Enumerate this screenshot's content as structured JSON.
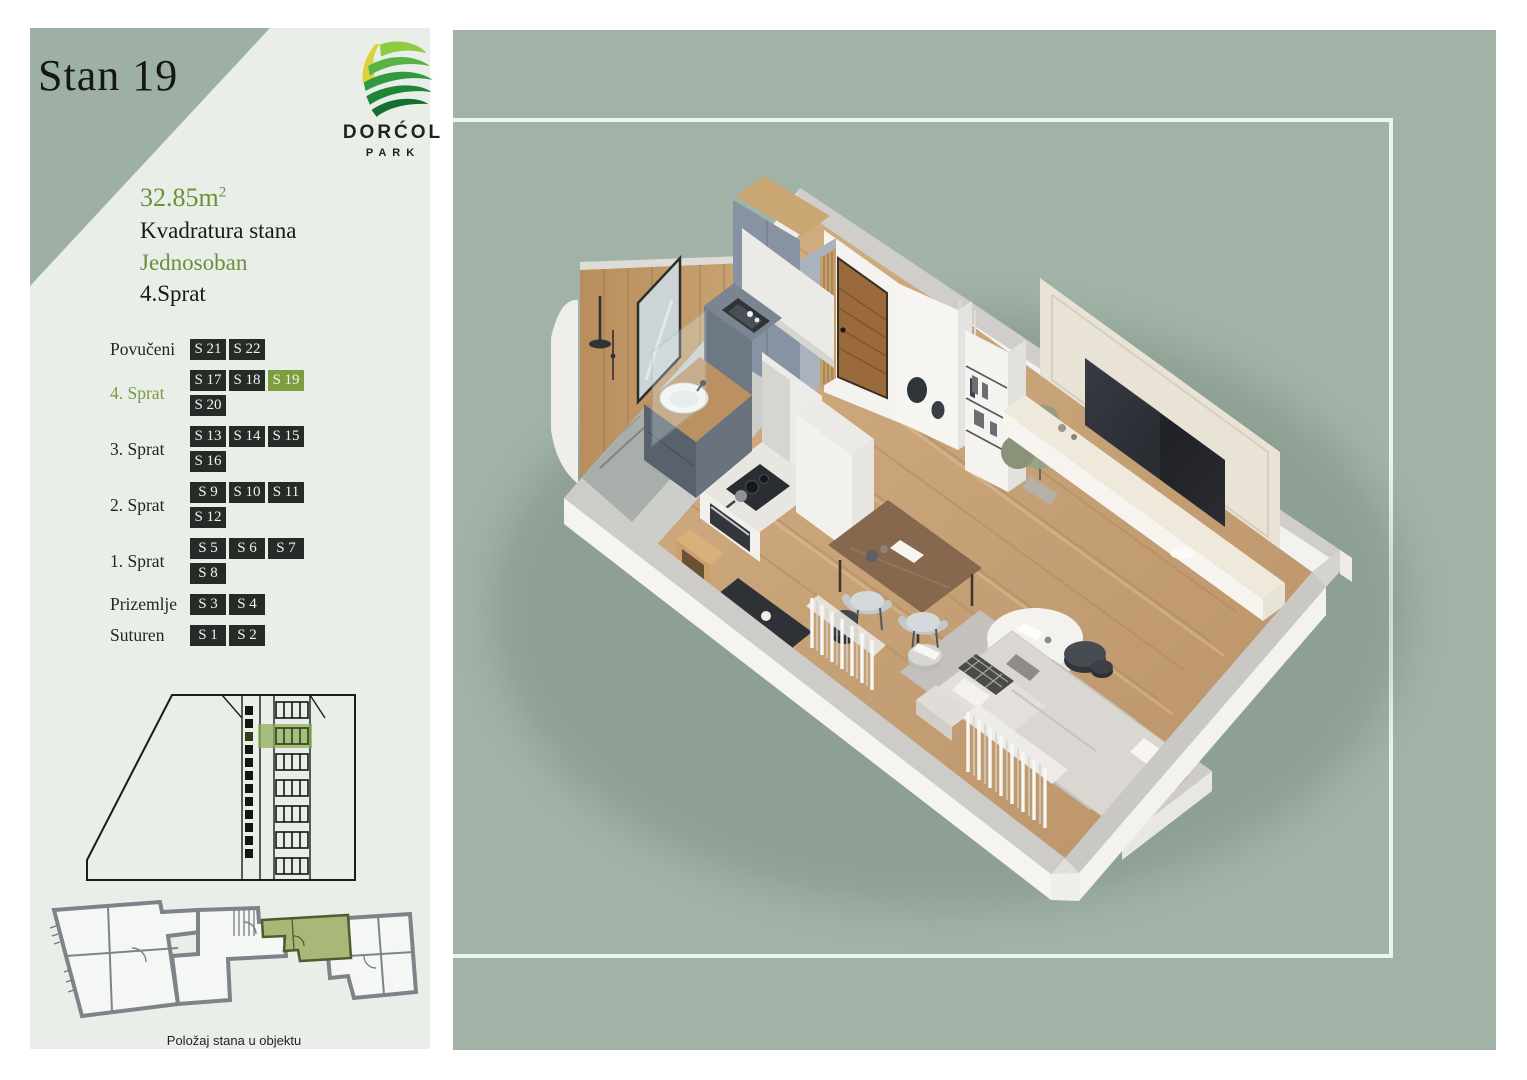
{
  "page": {
    "title": "Stan 19"
  },
  "logo": {
    "name": "DORĆOL",
    "sub": "PARK"
  },
  "details": {
    "area": "32.85m",
    "area_sup": "2",
    "area_label": "Kvadratura stana",
    "type": "Jednosoban",
    "floor": "4.Sprat"
  },
  "floors": [
    {
      "label": "Povučeni",
      "active_label": false,
      "active_unit": null,
      "units": [
        "S 21",
        "S 22"
      ]
    },
    {
      "label": "4. Sprat",
      "active_label": true,
      "active_unit": "S 19",
      "units": [
        "S 17",
        "S 18",
        "S 19",
        "S 20"
      ]
    },
    {
      "label": "3. Sprat",
      "active_label": false,
      "active_unit": null,
      "units": [
        "S 13",
        "S 14",
        "S 15",
        "S 16"
      ]
    },
    {
      "label": "2. Sprat",
      "active_label": false,
      "active_unit": null,
      "units": [
        "S 9",
        "S 10",
        "S 11",
        "S 12"
      ]
    },
    {
      "label": "1. Sprat",
      "active_label": false,
      "active_unit": null,
      "units": [
        "S 5",
        "S 6",
        "S 7",
        "S 8"
      ]
    },
    {
      "label": "Prizemlje",
      "active_label": false,
      "active_unit": null,
      "units": [
        "S 3",
        "S 4"
      ]
    },
    {
      "label": "Suturen",
      "active_label": false,
      "active_unit": null,
      "units": [
        "S 1",
        "S 2"
      ]
    }
  ],
  "diagrams": {
    "position_caption": "Položaj stana u objektu",
    "section_icon": "building-cross-section",
    "plan_icon": "floor-position-plan"
  },
  "colors": {
    "accent_green": "#7b9e3e",
    "text_green": "#6e8f38",
    "panel_green": "#a1b3a7",
    "panel_light": "#e9eee9",
    "chip_dark": "#262b27",
    "frame_white": "#edf3ee",
    "triangle": "#9db0a3",
    "highlight_unit_fill": "#a8b878"
  }
}
